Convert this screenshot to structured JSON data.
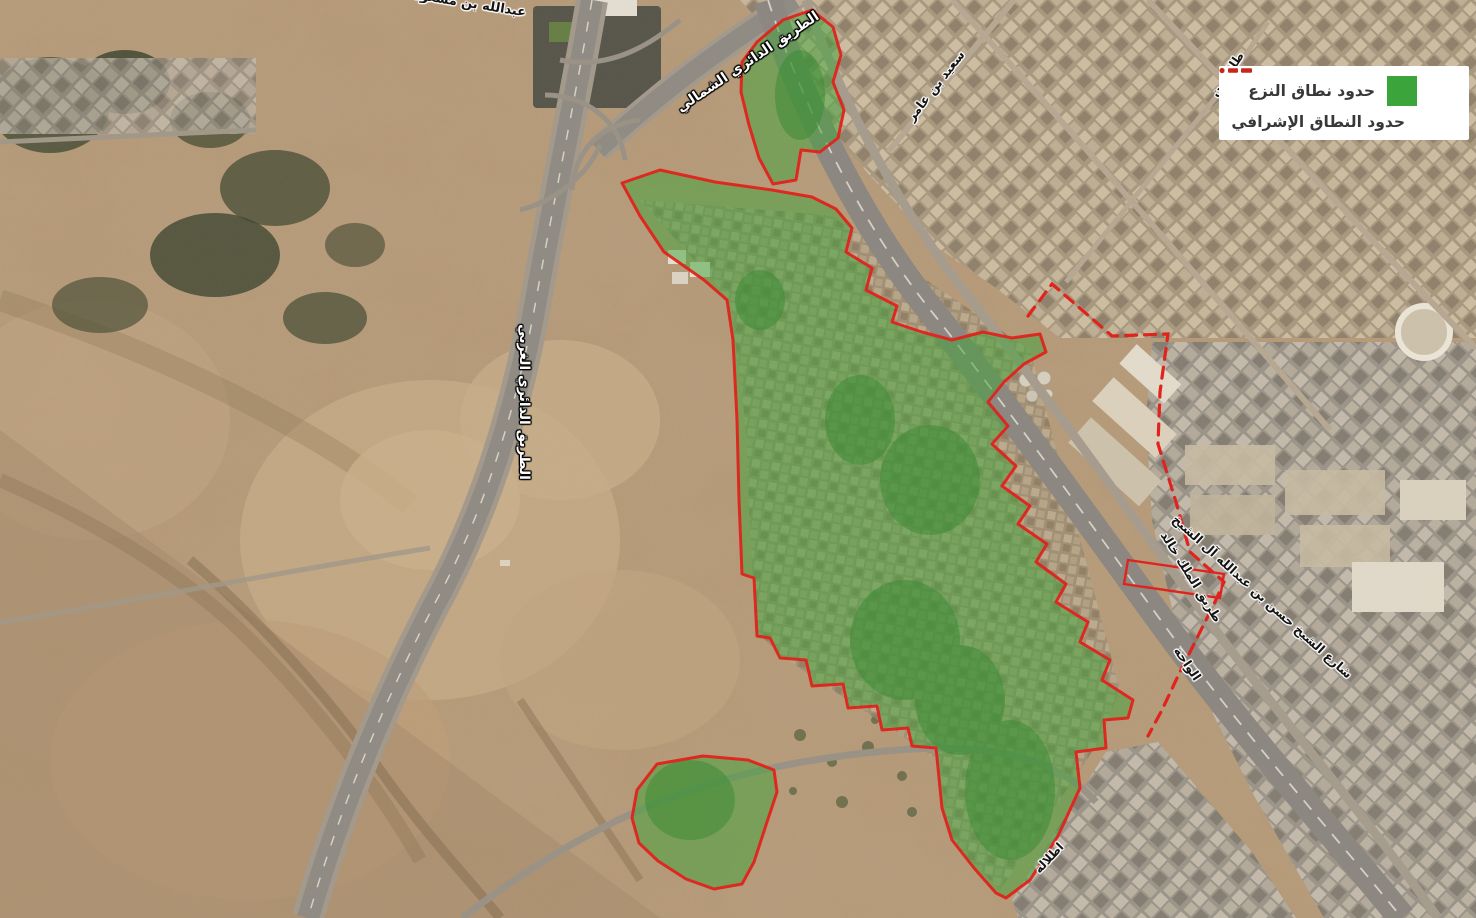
{
  "legend": {
    "expropriation": {
      "label": "حدود نطاق النزع"
    },
    "supervisory": {
      "label": "حدود النطاق الإشرافي"
    }
  },
  "map_labels": {
    "ibn_masoud_street": "عبدالله بن مسعود",
    "northern_ring_road": "الطريق الدائري الشمالي",
    "saeed_bin_amer_street": "سعيد بن عامر",
    "talal_street": "طلال بن",
    "western_ring_road": "الطريق الدائري الغربي",
    "king_khalid_road": "طريق الملك خالد",
    "sheikh_hassan_street": "شارع الشيخ حسن بن عبدالله آل الشيخ",
    "al_wahah_district": "الواحة",
    "itlalah_district": "اطلالة"
  },
  "colors": {
    "zone_fill": "#44a33c",
    "boundary_red": "#e0231c",
    "legend_green": "#3ba43b",
    "legend_red": "#c9251d"
  }
}
